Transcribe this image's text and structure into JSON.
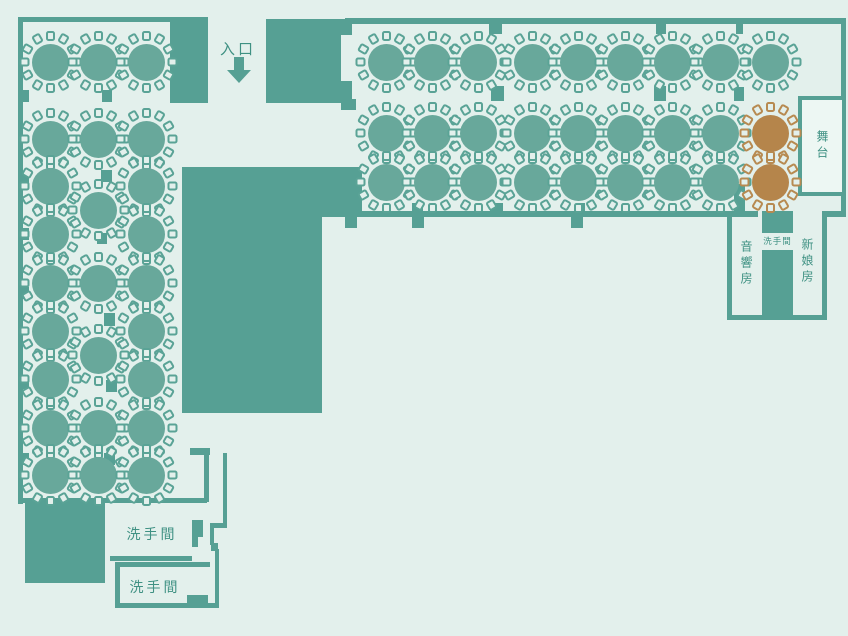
{
  "palette": {
    "background": "#e3f0ec",
    "wall": "#56a094",
    "table": "#68a89b",
    "chair": "#5aa396",
    "vip_table": "#b5854b",
    "vip_chair": "#b78a51",
    "text": "#3f9183",
    "stage_fill": "#edf7f3"
  },
  "labels": {
    "entrance": "入口",
    "stage": "舞台",
    "restroom": "洗手間",
    "audio_room": "音響房",
    "bride_room": "新娘房"
  },
  "seats_per_table": 12,
  "tables": [
    {
      "x": 50,
      "y": 62
    },
    {
      "x": 50,
      "y": 139
    },
    {
      "x": 50,
      "y": 186
    },
    {
      "x": 50,
      "y": 234
    },
    {
      "x": 50,
      "y": 283
    },
    {
      "x": 50,
      "y": 331
    },
    {
      "x": 50,
      "y": 379
    },
    {
      "x": 50,
      "y": 428
    },
    {
      "x": 50,
      "y": 475
    },
    {
      "x": 98,
      "y": 62
    },
    {
      "x": 98,
      "y": 139
    },
    {
      "x": 98,
      "y": 210
    },
    {
      "x": 98,
      "y": 283
    },
    {
      "x": 98,
      "y": 355
    },
    {
      "x": 98,
      "y": 428
    },
    {
      "x": 98,
      "y": 475
    },
    {
      "x": 146,
      "y": 62
    },
    {
      "x": 146,
      "y": 139
    },
    {
      "x": 146,
      "y": 186
    },
    {
      "x": 146,
      "y": 234
    },
    {
      "x": 146,
      "y": 283
    },
    {
      "x": 146,
      "y": 331
    },
    {
      "x": 146,
      "y": 379
    },
    {
      "x": 146,
      "y": 428
    },
    {
      "x": 146,
      "y": 475
    },
    {
      "x": 386,
      "y": 62
    },
    {
      "x": 432,
      "y": 62
    },
    {
      "x": 478,
      "y": 62
    },
    {
      "x": 532,
      "y": 62
    },
    {
      "x": 578,
      "y": 62
    },
    {
      "x": 625,
      "y": 62
    },
    {
      "x": 672,
      "y": 62
    },
    {
      "x": 720,
      "y": 62
    },
    {
      "x": 770,
      "y": 62
    },
    {
      "x": 386,
      "y": 133
    },
    {
      "x": 432,
      "y": 133
    },
    {
      "x": 478,
      "y": 133
    },
    {
      "x": 532,
      "y": 133
    },
    {
      "x": 578,
      "y": 133
    },
    {
      "x": 625,
      "y": 133
    },
    {
      "x": 672,
      "y": 133
    },
    {
      "x": 720,
      "y": 133
    },
    {
      "x": 770,
      "y": 133,
      "type": "vip"
    },
    {
      "x": 386,
      "y": 182
    },
    {
      "x": 432,
      "y": 182
    },
    {
      "x": 478,
      "y": 182
    },
    {
      "x": 532,
      "y": 182
    },
    {
      "x": 578,
      "y": 182
    },
    {
      "x": 625,
      "y": 182
    },
    {
      "x": 672,
      "y": 182
    },
    {
      "x": 720,
      "y": 182
    },
    {
      "x": 770,
      "y": 182,
      "type": "vip"
    }
  ]
}
